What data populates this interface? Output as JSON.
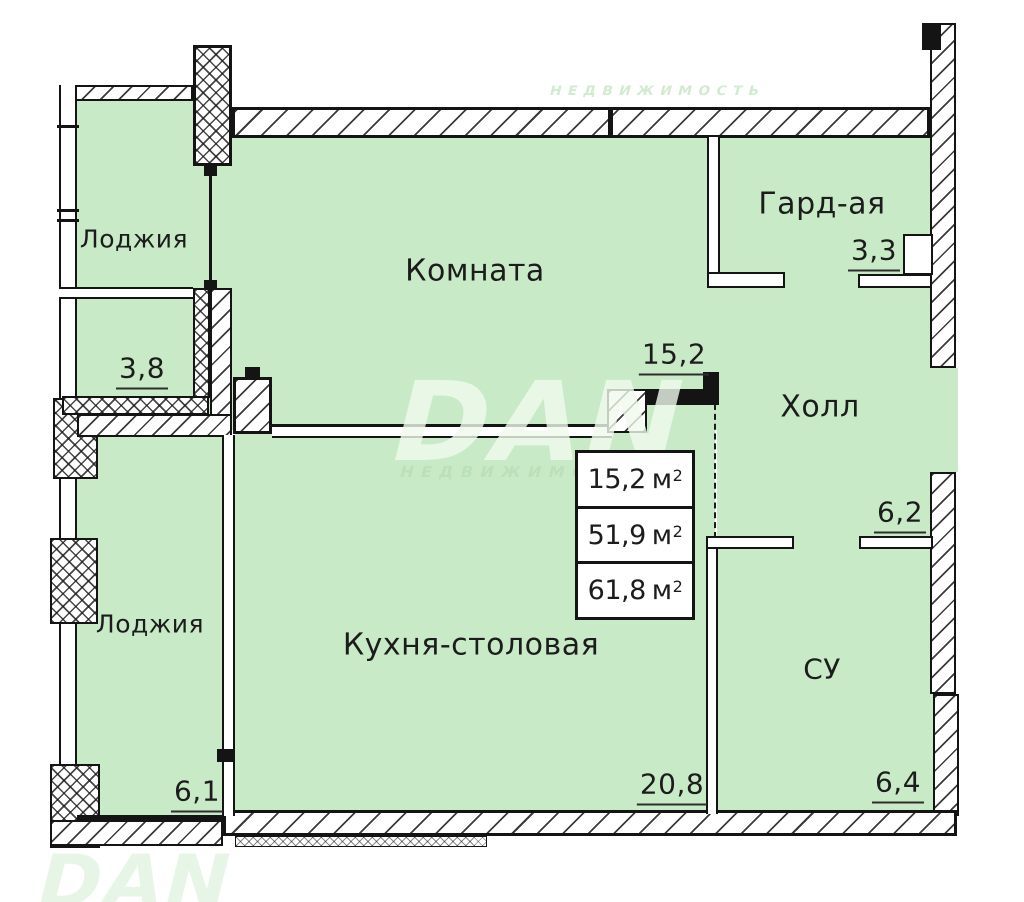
{
  "rooms": {
    "loggia_top": {
      "name": "Лоджия",
      "area": "3,8"
    },
    "room": {
      "name": "Комната",
      "area": "15,2"
    },
    "wardrobe": {
      "name": "Гард-ая",
      "area": "3,3"
    },
    "hall": {
      "name": "Холл",
      "area": "6,2"
    },
    "loggia_bottom": {
      "name": "Лоджия",
      "area": "6,1"
    },
    "kitchen": {
      "name": "Кухня-столовая",
      "area": "20,8"
    },
    "bathroom": {
      "name": "СУ",
      "area": "6,4"
    }
  },
  "area_table": {
    "rows": [
      {
        "value": "15,2",
        "unit": "м",
        "sup": "2"
      },
      {
        "value": "51,9",
        "unit": "м",
        "sup": "2"
      },
      {
        "value": "61,8",
        "unit": "м",
        "sup": "2"
      }
    ]
  },
  "watermark": {
    "logo": "DAN",
    "subtitle": "НЕДВИЖИМОСТЬ"
  },
  "colors": {
    "room_fill": "#c9eac7",
    "wall_line": "#141414"
  }
}
